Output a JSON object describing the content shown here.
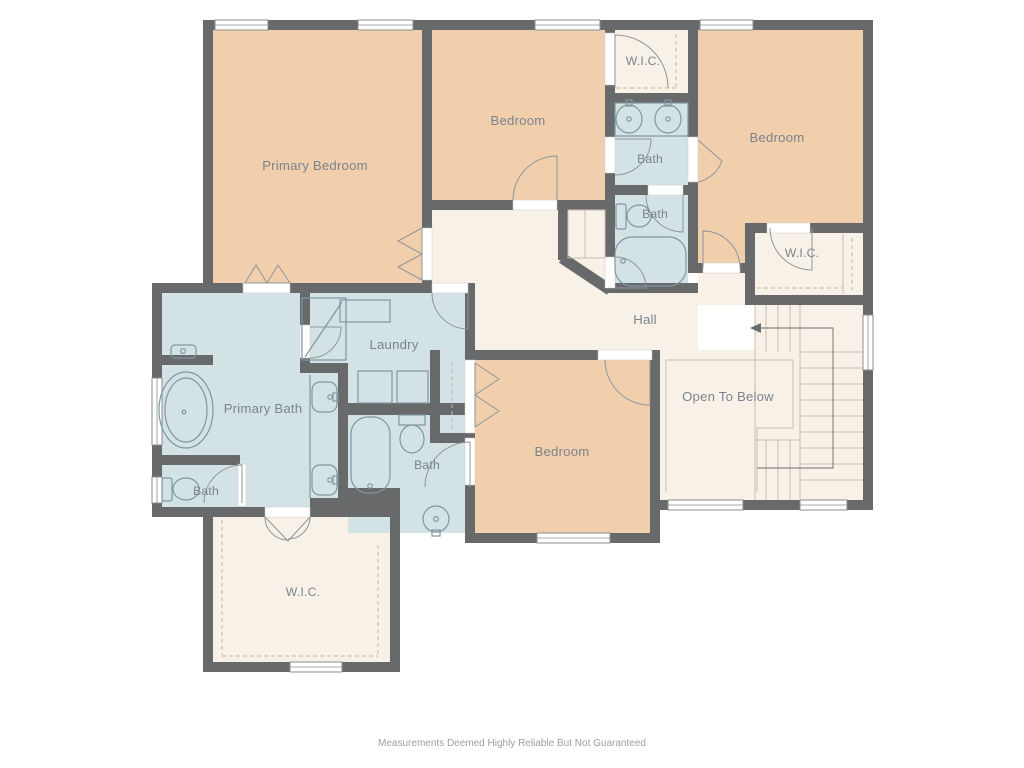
{
  "plan": {
    "rooms": {
      "primary_bedroom": "Primary Bedroom",
      "bedroom_top": "Bedroom",
      "bedroom_right": "Bedroom",
      "bedroom_bottom": "Bedroom",
      "wic_top": "W.I.C.",
      "wic_right": "W.I.C.",
      "wic_bottom": "W.I.C.",
      "bath_jack_jill": "Bath",
      "bath_hall": "Bath",
      "primary_bath": "Primary Bath",
      "bath_primary_wc": "Bath",
      "bath_ensuite": "Bath",
      "laundry": "Laundry",
      "hall": "Hall",
      "open_to_below": "Open To Below"
    },
    "footer": {
      "disclaimer": "Measurements Deemed Highly Reliable But Not Guaranteed"
    },
    "palette": {
      "bedroom_fill": "#f2cfac",
      "bath_fill": "#d3e2e4",
      "hall_fill": "#f8f1e7",
      "wall": "#67696b",
      "window_stroke": "#8a8d8f",
      "fixture_stroke": "#7f97a1",
      "door_stroke": "#8f9599",
      "line_cream": "#c9c0b2",
      "closet_dash": "#c2b6a6",
      "label_text": "#7b848d",
      "note_text": "#9aa0a4",
      "arrow": "#6a6d70"
    }
  }
}
